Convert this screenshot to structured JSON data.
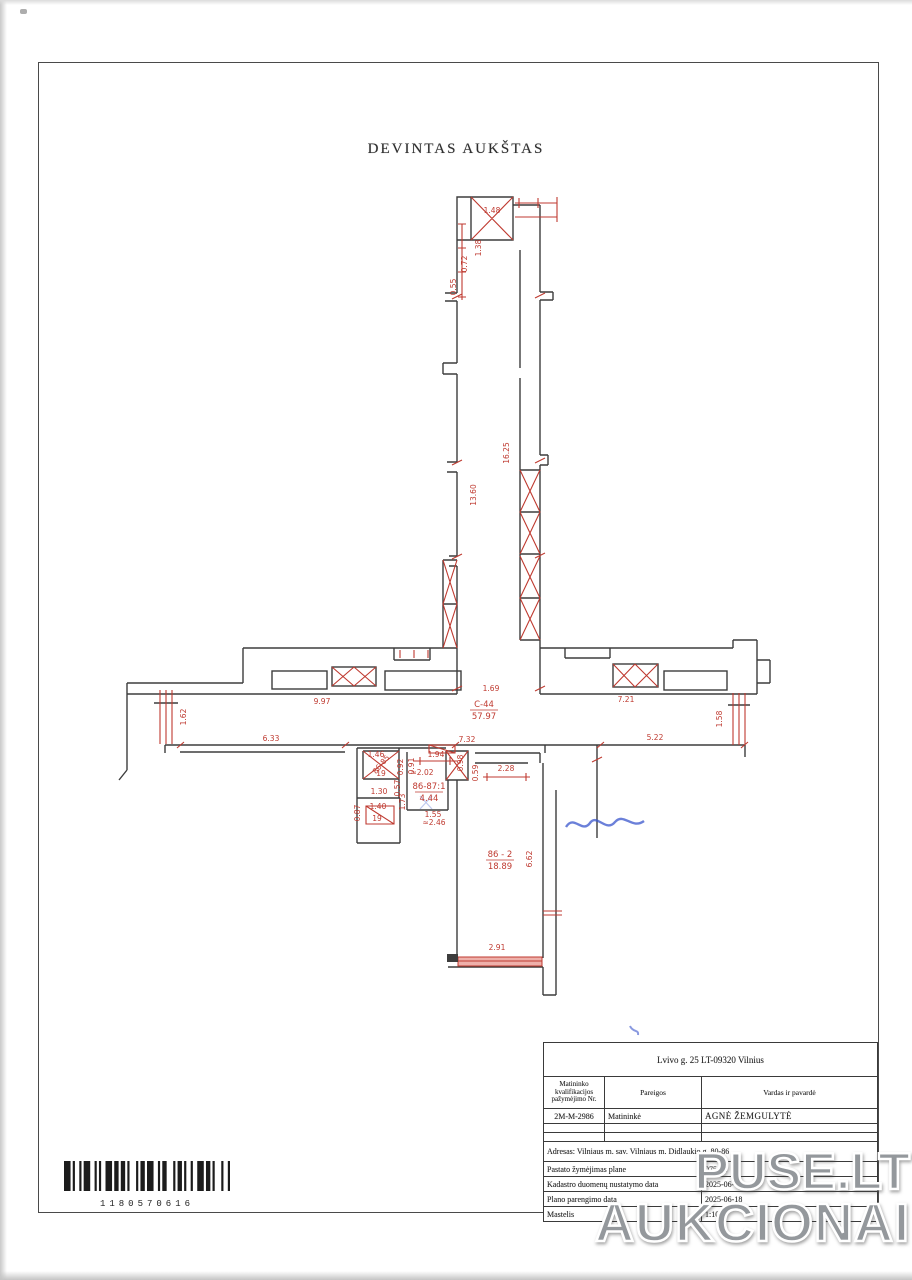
{
  "page": {
    "title": "DEVINTAS AUKŠTAS"
  },
  "watermark": {
    "line1": "PUSE.LT",
    "line2": "AUKCIONAI"
  },
  "barcode": {
    "number": "1180570616"
  },
  "title_block": {
    "address_header": "Lvivo g. 25 LT-09320 Vilnius",
    "columns": [
      "Matininko kvalifikacijos pažymėjimo Nr.",
      "Pareigos",
      "Vardas ir pavardė"
    ],
    "surveyor": {
      "cert_no": "2M-M-2986",
      "position": "Matininkė",
      "name": "AGNĖ ŽEMGULYTĖ"
    },
    "address_row": "Adresas: Vilniaus m. sav. Vilniaus m. Didlaukio g. 80-86",
    "rows": [
      {
        "label": "Pastato žymėjimas plane",
        "value": "075dln"
      },
      {
        "label": "Kadastro duomenų nustatymo data",
        "value": "2025-06-16"
      },
      {
        "label": "Plano parengimo data",
        "value": "2025-06-18"
      },
      {
        "label": "Mastelis",
        "value": "1:100"
      }
    ]
  },
  "plan": {
    "rooms": [
      {
        "id": "C-44",
        "area": "57.97",
        "x": 484,
        "y": 707
      },
      {
        "id": "86-87:1",
        "area": "4.44",
        "x": 429,
        "y": 789
      },
      {
        "id": "86 - 2",
        "area": "18.89",
        "x": 500,
        "y": 857
      }
    ],
    "dimensions": [
      {
        "t": "1.48",
        "x": 492,
        "y": 213,
        "r": 0
      },
      {
        "t": "1.38",
        "x": 481,
        "y": 248,
        "r": -90
      },
      {
        "t": "0.72",
        "x": 467,
        "y": 264,
        "r": -90
      },
      {
        "t": "0.55",
        "x": 456,
        "y": 287,
        "r": -90
      },
      {
        "t": "16.25",
        "x": 509,
        "y": 453,
        "r": -90
      },
      {
        "t": "13.60",
        "x": 476,
        "y": 495,
        "r": -90
      },
      {
        "t": "1.69",
        "x": 491,
        "y": 691,
        "r": 0
      },
      {
        "t": "9.97",
        "x": 322,
        "y": 704,
        "r": 0
      },
      {
        "t": "7.21",
        "x": 626,
        "y": 702,
        "r": 0
      },
      {
        "t": "1.62",
        "x": 186,
        "y": 717,
        "r": -90
      },
      {
        "t": "1.58",
        "x": 722,
        "y": 719,
        "r": -90
      },
      {
        "t": "6.33",
        "x": 271,
        "y": 741,
        "r": 0
      },
      {
        "t": "7.32",
        "x": 467,
        "y": 742,
        "r": 0
      },
      {
        "t": "5.22",
        "x": 655,
        "y": 740,
        "r": 0
      },
      {
        "t": "1.46",
        "x": 376,
        "y": 757,
        "r": 0
      },
      {
        "t": "86-85",
        "x": 383,
        "y": 766,
        "r": -50
      },
      {
        "t": "19",
        "x": 381,
        "y": 776,
        "r": 0
      },
      {
        "t": "0.92",
        "x": 403,
        "y": 767,
        "r": -90
      },
      {
        "t": "0.91",
        "x": 414,
        "y": 766,
        "r": -90
      },
      {
        "t": "1.94",
        "x": 436,
        "y": 757,
        "r": 0
      },
      {
        "t": "0.98",
        "x": 463,
        "y": 763,
        "r": -90
      },
      {
        "t": "0.59",
        "x": 478,
        "y": 773,
        "r": -90
      },
      {
        "t": "2.28",
        "x": 506,
        "y": 771,
        "r": 0
      },
      {
        "t": "≈2.02",
        "x": 422,
        "y": 775,
        "r": 0
      },
      {
        "t": "0.57",
        "x": 400,
        "y": 788,
        "r": -90
      },
      {
        "t": "1.30",
        "x": 379,
        "y": 794,
        "r": 0
      },
      {
        "t": "1.73",
        "x": 405,
        "y": 802,
        "r": -90
      },
      {
        "t": "0.87",
        "x": 360,
        "y": 813,
        "r": -90
      },
      {
        "t": "1.40",
        "x": 378,
        "y": 809,
        "r": 0
      },
      {
        "t": "19",
        "x": 377,
        "y": 821,
        "r": 0
      },
      {
        "t": "1.55",
        "x": 433,
        "y": 817,
        "r": 0
      },
      {
        "t": "≈2.46",
        "x": 434,
        "y": 825,
        "r": 0
      },
      {
        "t": "6.62",
        "x": 532,
        "y": 859,
        "r": -90
      },
      {
        "t": "2.91",
        "x": 497,
        "y": 950,
        "r": 0
      }
    ]
  }
}
